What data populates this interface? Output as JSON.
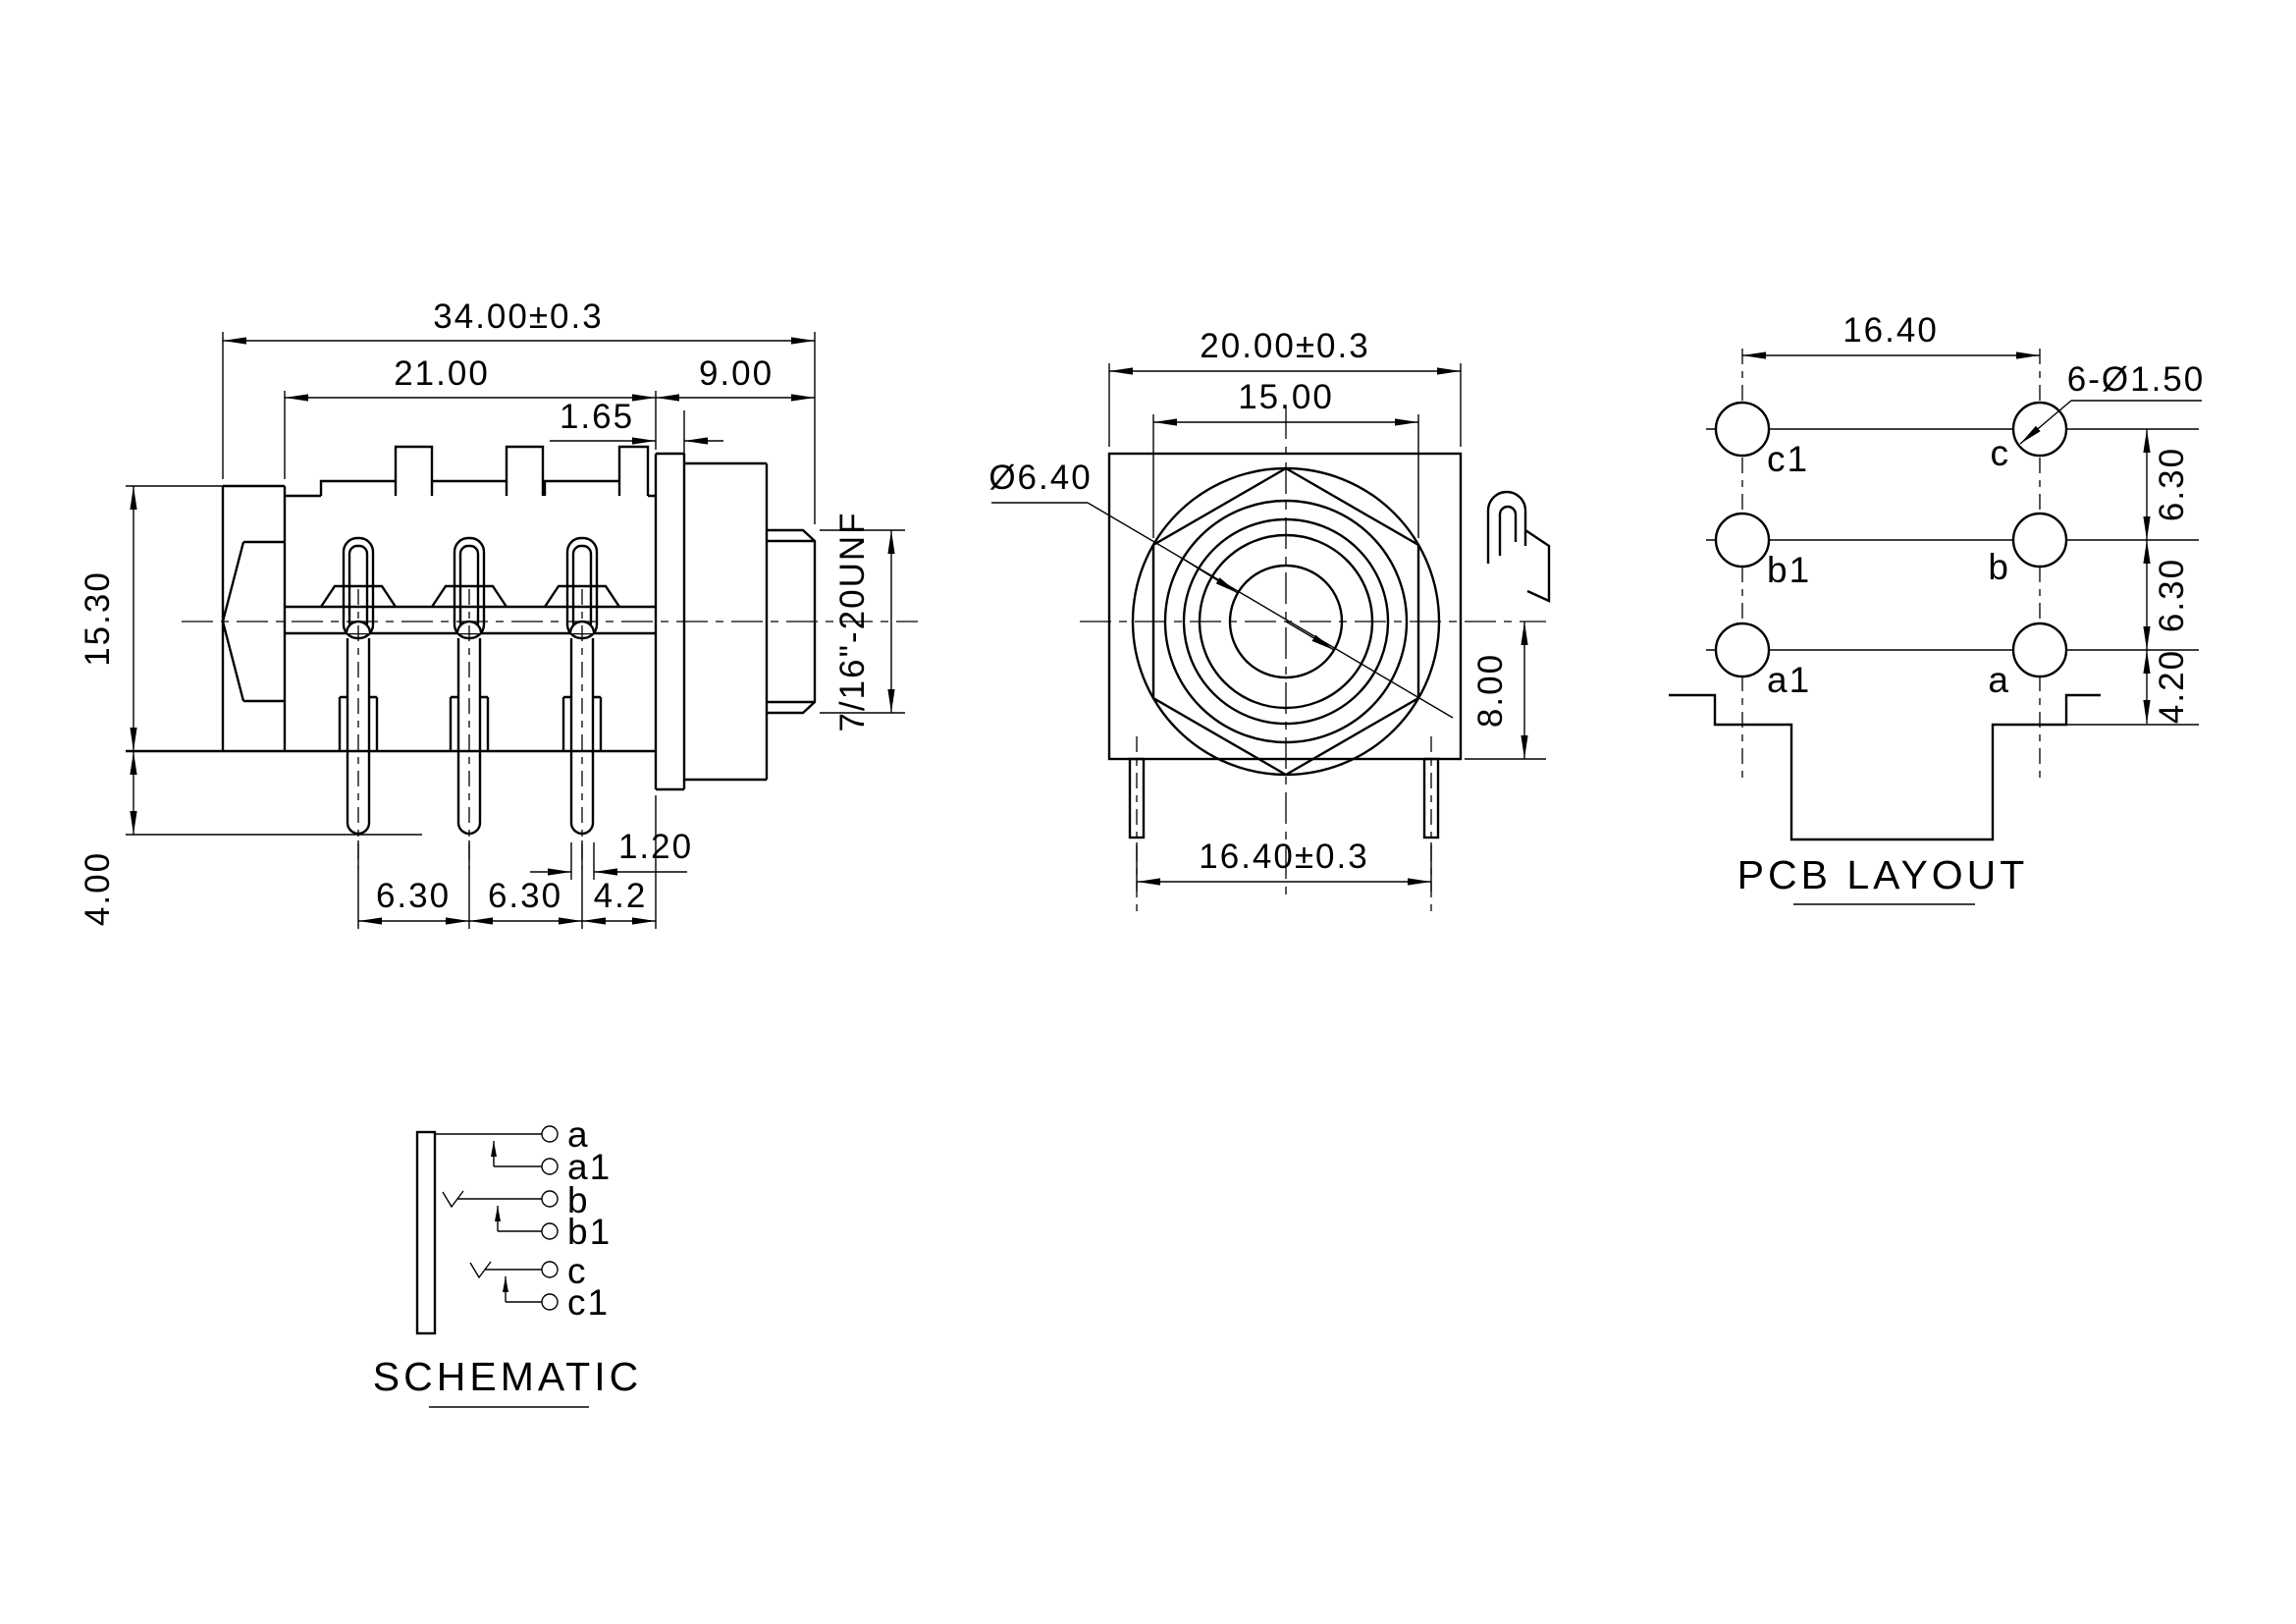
{
  "side_view": {
    "dim_overall_length": "34.00±0.3",
    "dim_body_length": "21.00",
    "dim_bushing_length": "9.00",
    "dim_washer_thickness": "1.65",
    "dim_body_height": "15.30",
    "dim_pin_length": "4.00",
    "dim_pin_pitch_1": "6.30",
    "dim_pin_pitch_2": "6.30",
    "dim_pin_to_edge": "4.2",
    "dim_pin_width": "1.20",
    "thread_spec": "7/16\"-20UNF"
  },
  "front_view": {
    "dim_body_width": "20.00±0.3",
    "dim_nut_flats": "15.00",
    "dim_bore": "Ø6.40",
    "dim_center_to_bottom": "8.00",
    "dim_pin_span": "16.40±0.3"
  },
  "pcb_layout": {
    "title": "PCB LAYOUT",
    "dim_hole_span": "16.40",
    "dim_hole_spec": "6-Ø1.50",
    "dim_row_pitch_1": "6.30",
    "dim_row_pitch_2": "6.30",
    "dim_row_to_edge": "4.20",
    "pads": {
      "c1": "c1",
      "c": "c",
      "b1": "b1",
      "b": "b",
      "a1": "a1",
      "a": "a"
    }
  },
  "schematic": {
    "title": "SCHEMATIC",
    "terminals": {
      "a": "a",
      "a1": "a1",
      "b": "b",
      "b1": "b1",
      "c": "c",
      "c1": "c1"
    }
  }
}
